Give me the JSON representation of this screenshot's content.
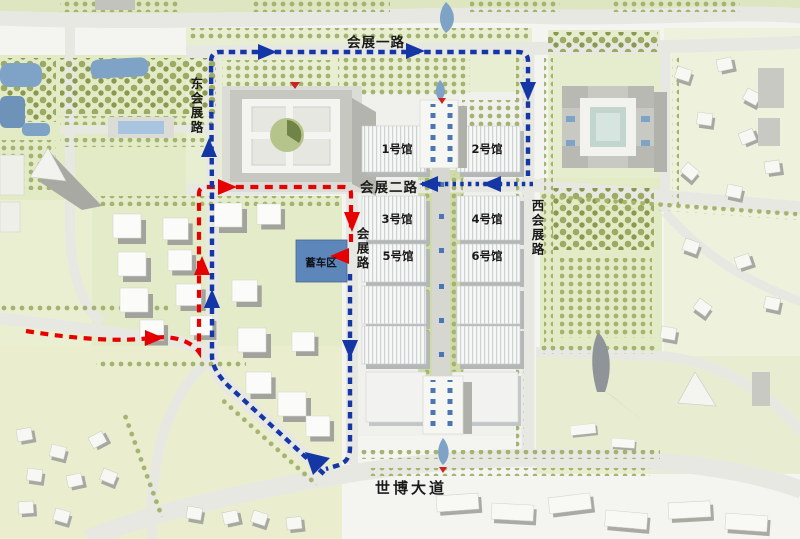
{
  "map": {
    "title": "exhibition-center-site-plan",
    "roads": {
      "huizhan_yi_lu": "会展一路",
      "dong_huizhan_lu": "东会展路",
      "huizhan_er_lu": "会展二路",
      "huizhan_lu": "会展路",
      "xi_huizhan_lu": "西会展路",
      "shibo_dadao": "世博大道"
    },
    "halls": [
      {
        "label": "1号馆"
      },
      {
        "label": "2号馆"
      },
      {
        "label": "3号馆"
      },
      {
        "label": "4号馆"
      },
      {
        "label": "5号馆"
      },
      {
        "label": "6号馆"
      }
    ],
    "staging_label": "蓄车区"
  },
  "colors": {
    "route_blue": "#1537a5",
    "route_red": "#e60000",
    "staging_area": "#5d86ba",
    "road": "#e8e8e3",
    "park_green": "#e3eac6",
    "water": "#7fa3c6"
  }
}
